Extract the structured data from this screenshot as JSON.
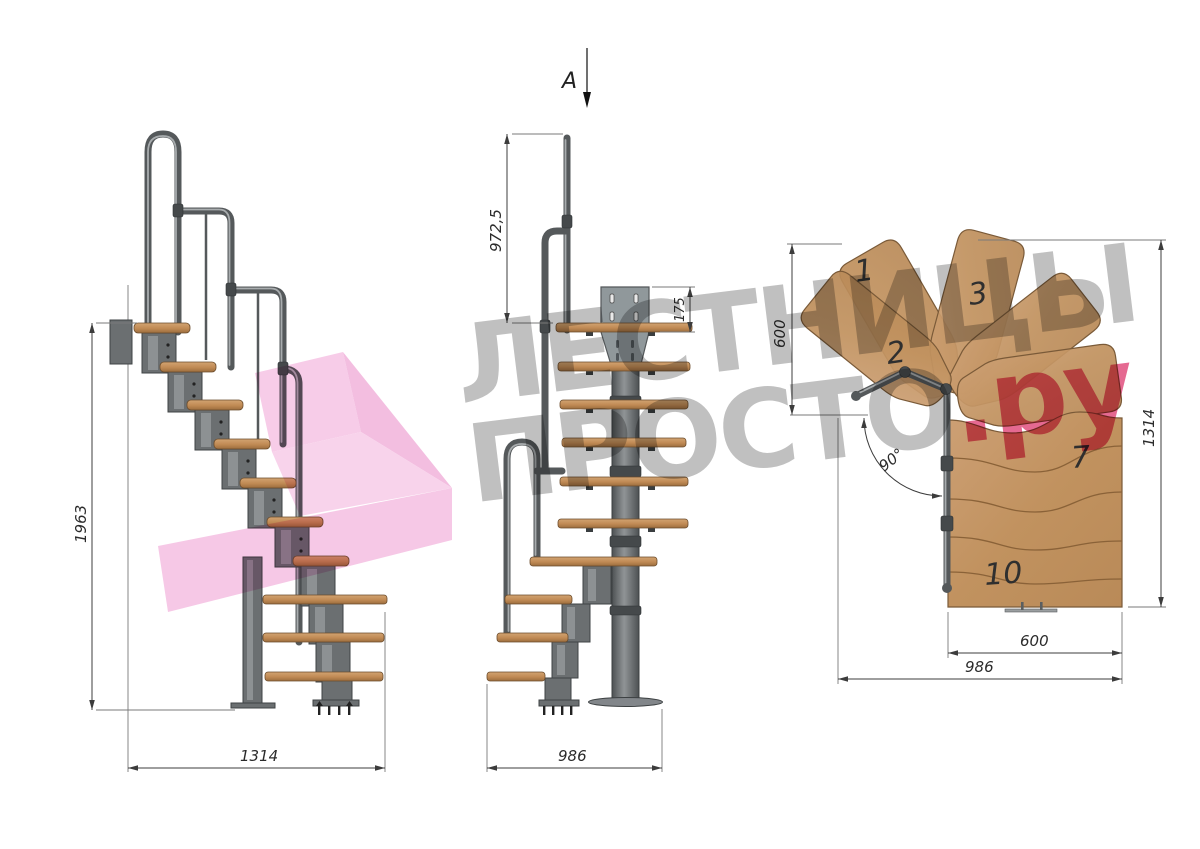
{
  "watermark": {
    "line1": "ЛЕСТНИЦЫ",
    "line2_gray": "ПРОСТО",
    "line2_pink": ".ру"
  },
  "section_marker": {
    "label": "A"
  },
  "side_view": {
    "dim_height": "1963",
    "dim_width": "1314"
  },
  "front_view": {
    "dim_rail_height": "972,5",
    "dim_plate": "175",
    "dim_width": "986"
  },
  "plan_view": {
    "step_labels": {
      "s1": "1",
      "s2": "2",
      "s3": "3",
      "s7": "7",
      "s10": "10"
    },
    "dim_left": "600",
    "dim_right": "1314",
    "dim_bottom_inner": "600",
    "dim_bottom_outer": "986",
    "dim_angle": "90°"
  },
  "colors": {
    "wood": "#c49a6e",
    "metal": "#5f6365",
    "watermark_gray": "#b5b5b5",
    "watermark_pink": "#e14e7e",
    "arrow_pink": "#f2a9d8",
    "dimension": "#3c3c3c"
  }
}
